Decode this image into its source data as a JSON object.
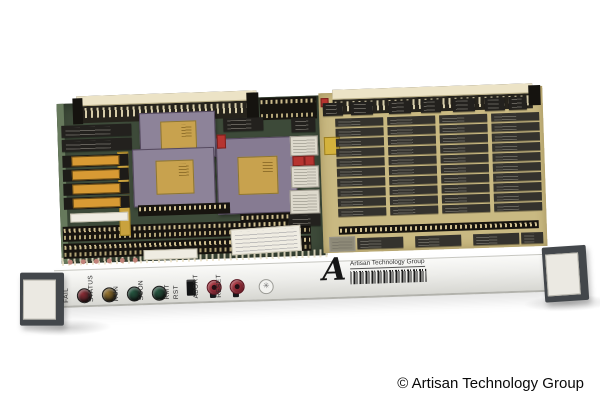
{
  "photo": {
    "copyright": "© Artisan Technology Group",
    "front_panel": {
      "leds": [
        {
          "label": "FAIL",
          "color": "#8a2a33"
        },
        {
          "label": "STATUS",
          "color": "#97742c"
        },
        {
          "label": "RUN",
          "color": "#23553f"
        },
        {
          "label": "SCON",
          "color": "#23553f"
        }
      ],
      "remote_reset_words": [
        "RMT",
        "RST"
      ],
      "toggles": [
        {
          "label": "ABORT",
          "cap_color": "#b03a44"
        },
        {
          "label": "RESET",
          "cap_color": "#b03a44"
        }
      ],
      "logo": {
        "initial": "A",
        "name": "Artisan Technology Group"
      }
    },
    "board": {
      "pcb_color": "#3d4a39",
      "pcb_edge_color": "#66795c",
      "memory_board_color": "#c9b982",
      "chip_color": "#23211e",
      "memory_chip_color": "#34322d",
      "eprom_window_color": "#d89a34",
      "pga_body_color": "#8d8399",
      "pga_lid_color": "#c8a24e",
      "memory_grid": {
        "columns": 4,
        "rows": 10
      },
      "eprom_count": 4
    }
  }
}
